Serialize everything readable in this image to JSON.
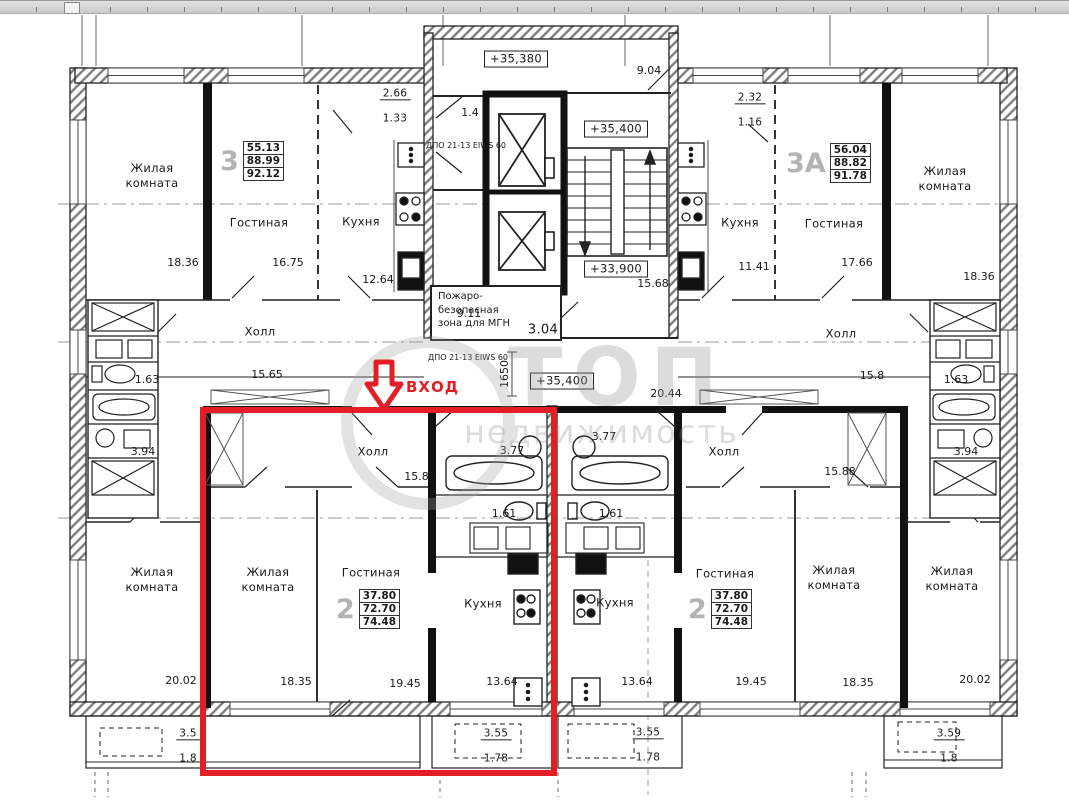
{
  "watermark": {
    "line1": "ТОП",
    "line2": "недвижимость"
  },
  "entrance": {
    "label": "ВХОД"
  },
  "colors": {
    "highlight": "#e31e24"
  },
  "core": {
    "level_top": "+35,380",
    "level_landing": "+35,400",
    "level_mid": "+33,900",
    "level_corridor": "+35,400",
    "dim_top_right": "9.04",
    "dim_lobby": "1.4",
    "door_spec_top": "ДПО 21-13 EIWS 60",
    "door_spec_mid": "ДПО 21-13 EIWS 60",
    "dim_stairs": "15.68",
    "fire_zone_label": "Пожаро-\nбезопасная\nзона для МГН",
    "fire_zone_area": "3.04",
    "dim_fire_zone": "9.11",
    "dim_corridor_height": "1650",
    "dim_corridor": "20.44"
  },
  "apt3": {
    "number": "3",
    "areas": [
      "55.13",
      "88.99",
      "92.12"
    ],
    "rooms": {
      "living": {
        "name": "Жилая\nкомната",
        "area": "18.36"
      },
      "lounge": {
        "name": "Гостиная",
        "area": "16.75"
      },
      "kitchen": {
        "name": "Кухня",
        "area": "12.64"
      },
      "hall": {
        "name": "Холл",
        "area": "15.65"
      },
      "wc": {
        "area": "1.63"
      },
      "bath": {
        "area": "3.94"
      },
      "balcony": {
        "a": "2.66",
        "b": "1.33"
      }
    }
  },
  "apt3a": {
    "number": "3А",
    "areas": [
      "56.04",
      "88.82",
      "91.78"
    ],
    "rooms": {
      "kitchen": {
        "name": "Кухня",
        "area": "11.41"
      },
      "lounge": {
        "name": "Гостиная",
        "area": "17.66"
      },
      "living": {
        "name": "Жилая\nкомната",
        "area": "18.36"
      },
      "hall": {
        "name": "Холл",
        "area": "15.8"
      },
      "wc": {
        "area": "1.63"
      },
      "bath": {
        "area": "3.94"
      },
      "balcony": {
        "a": "2.32",
        "b": "1.16"
      }
    }
  },
  "apt2_left": {
    "number": "2",
    "areas": [
      "37.80",
      "72.70",
      "74.48"
    ],
    "rooms": {
      "hall": {
        "name": "Холл",
        "area": "15.88"
      },
      "bath": {
        "area": "3.77"
      },
      "wc": {
        "area": "1.61"
      },
      "living": {
        "name": "Жилая\nкомната",
        "area": "18.35"
      },
      "lounge": {
        "name": "Гостиная",
        "area": "19.45"
      },
      "kitchen": {
        "name": "Кухня",
        "area": "13.64"
      },
      "balcony": {
        "a": "3.55",
        "b": "1.78"
      }
    }
  },
  "apt2_right": {
    "number": "2",
    "areas": [
      "37.80",
      "72.70",
      "74.48"
    ],
    "rooms": {
      "hall": {
        "name": "Холл",
        "area": "15.88"
      },
      "bath": {
        "area": "3.77"
      },
      "wc": {
        "area": "1.61"
      },
      "kitchen": {
        "name": "Кухня",
        "area": "13.64"
      },
      "lounge": {
        "name": "Гостиная",
        "area": "19.45"
      },
      "living": {
        "name": "Жилая\nкомната",
        "area": "18.35"
      },
      "balcony": {
        "a": "3.55",
        "b": "1.78"
      }
    }
  },
  "corner_left": {
    "room": {
      "name": "Жилая\nкомната",
      "area": "20.02"
    },
    "balcony": {
      "a": "3.5",
      "b": "1.8"
    }
  },
  "corner_right": {
    "room": {
      "name": "Жилая\nкомната",
      "area": "20.02"
    },
    "balcony": {
      "a": "3.59",
      "b": "1.8"
    }
  }
}
